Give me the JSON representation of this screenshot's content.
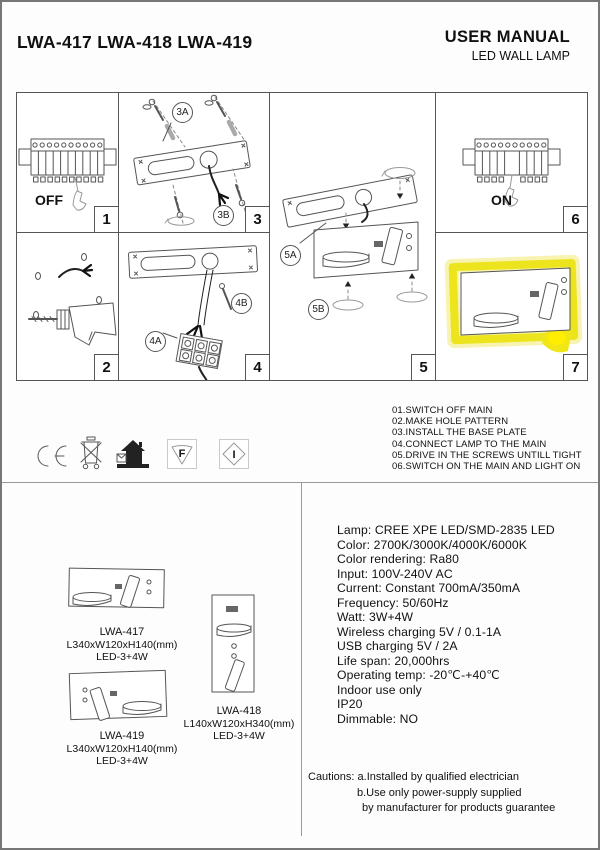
{
  "header": {
    "models": "LWA-417 LWA-418 LWA-419",
    "title": "USER MANUAL",
    "subtitle": "LED WALL LAMP"
  },
  "steps": {
    "p1": {
      "number": "1",
      "switch_label": "OFF"
    },
    "p2": {
      "number": "2"
    },
    "p3": {
      "number": "3",
      "tag_a": "3A",
      "tag_b": "3B"
    },
    "p4": {
      "number": "4",
      "tag_a": "4A",
      "tag_b": "4B"
    },
    "p5": {
      "number": "5",
      "tag_a": "5A",
      "tag_b": "5B"
    },
    "p6": {
      "number": "6",
      "switch_label": "ON"
    },
    "p7": {
      "number": "7"
    }
  },
  "instructions": [
    "01.SWITCH OFF MAIN",
    "02.MAKE HOLE PATTERN",
    "03.INSTALL THE BASE PLATE",
    "04.CONNECT LAMP TO THE MAIN",
    "05.DRIVE IN THE SCREWS UNTILL TIGHT",
    "06.SWITCH ON THE MAIN AND LIGHT ON"
  ],
  "certifications": {
    "icons": [
      "ce-mark",
      "weee-crossed-bin",
      "indoor-use-house",
      "f-mark-triangle",
      "class-i-diamond"
    ],
    "f": "F",
    "i": "I"
  },
  "specs": [
    "Lamp: CREE XPE LED/SMD-2835 LED",
    "Color: 2700K/3000K/4000K/6000K",
    "Color rendering: Ra80",
    "Input: 100V-240V AC",
    "Current: Constant 700mA/350mA",
    "Frequency: 50/60Hz",
    "Watt: 3W+4W",
    "Wireless charging 5V / 0.1-1A",
    "USB charging 5V / 2A",
    "Life span: 20,000hrs",
    "Operating temp: -20℃-+40℃",
    "Indoor use only",
    "IP20",
    "Dimmable: NO"
  ],
  "products": {
    "lwa417": {
      "model": "LWA-417",
      "dimensions": "L340xW120xH140(mm)",
      "led": "LED-3+4W"
    },
    "lwa418": {
      "model": "LWA-418",
      "dimensions": "L140xW120xH340(mm)",
      "led": "LED-3+4W"
    },
    "lwa419": {
      "model": "LWA-419",
      "dimensions": "L340xW120xH140(mm)",
      "led": "LED-3+4W"
    }
  },
  "cautions": {
    "label": "Cautions:",
    "line_a": "a.Installed by qualified electrician",
    "line_b": "b.Use only power-supply supplied",
    "line_c": "by manufacturer for products guarantee"
  },
  "colors": {
    "highlight_yellow": "#ece41d",
    "line_gray": "#555555"
  }
}
